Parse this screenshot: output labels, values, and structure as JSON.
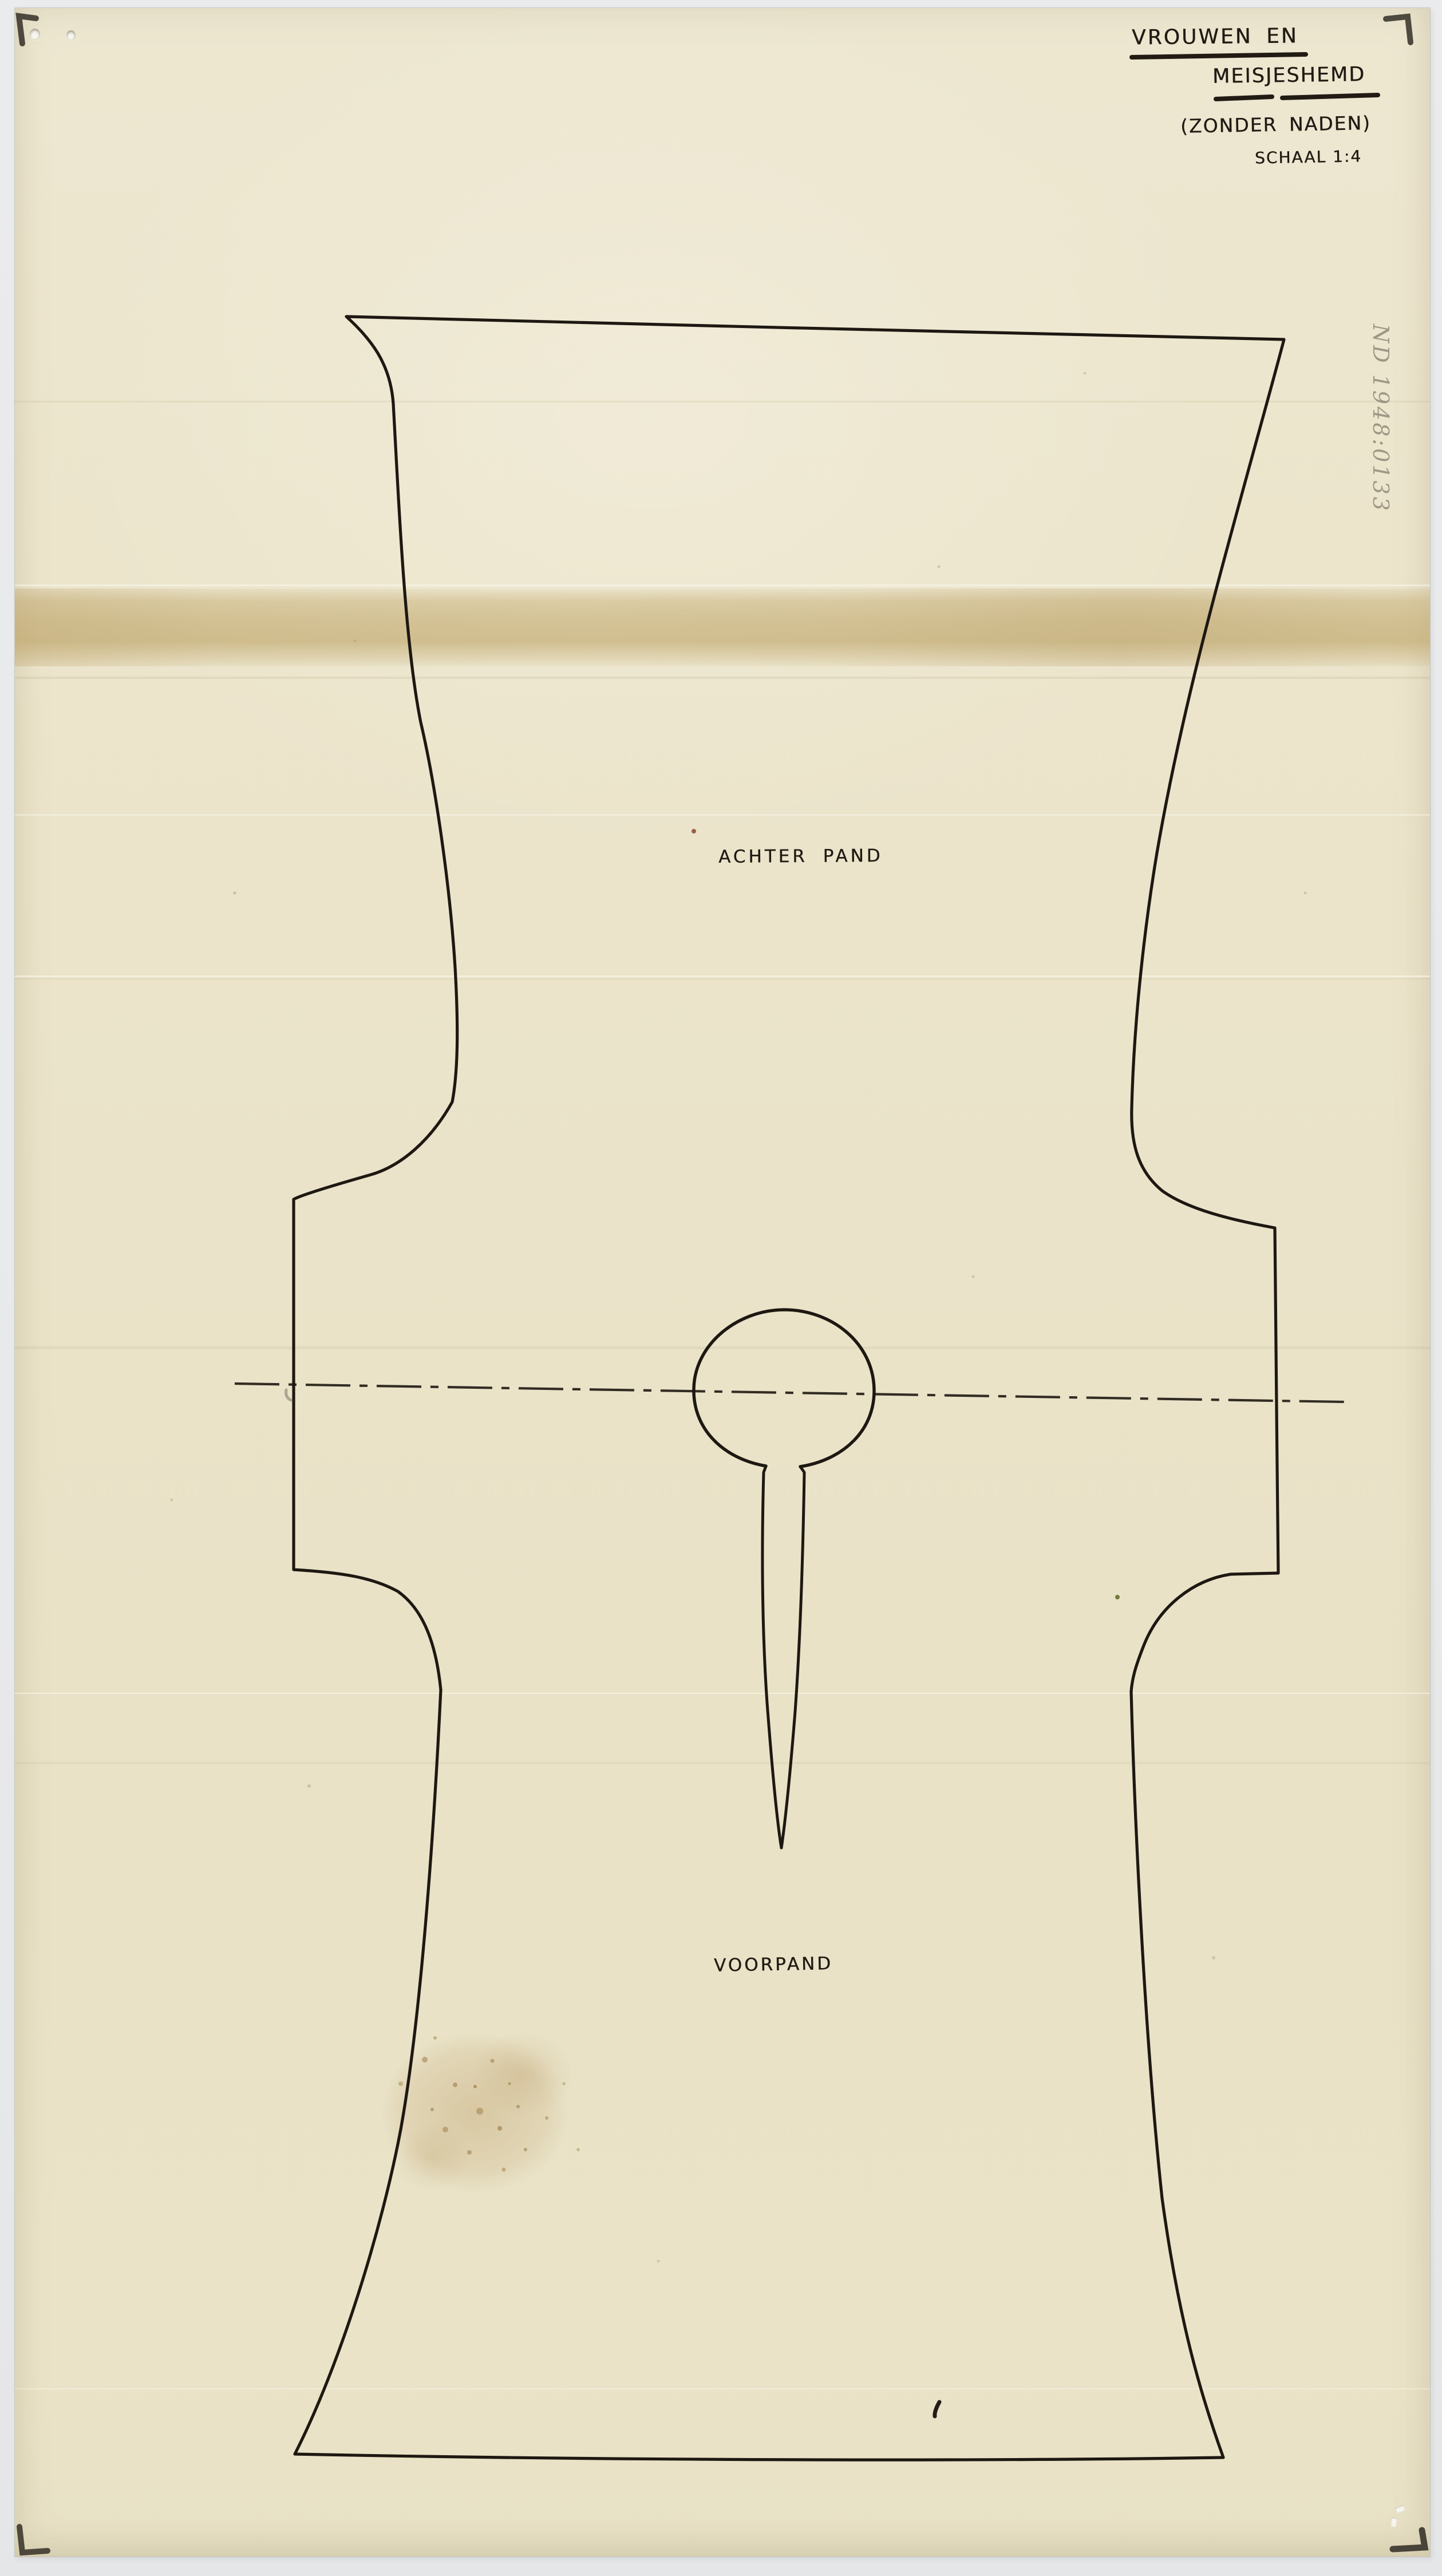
{
  "page": {
    "kind": "scanned archival sewing pattern sheet",
    "background_color": "#e8e9eb",
    "paper_color": "#ebe4ca",
    "ink_color": "#211b14",
    "pencil_color": "#8e8676",
    "stain_color": "#c9ae7d"
  },
  "header": {
    "title_line1": "VROUWEN EN",
    "title_line2": "MEISJESHEMD",
    "subtitle": "(ZONDER NADEN)",
    "scale_label": "SCHAAL 1:4"
  },
  "pattern": {
    "back_panel_label": "ACHTER PAND",
    "front_panel_label": "VOORPAND"
  },
  "annotations": {
    "inventory_number": "ND 1948:0133"
  }
}
